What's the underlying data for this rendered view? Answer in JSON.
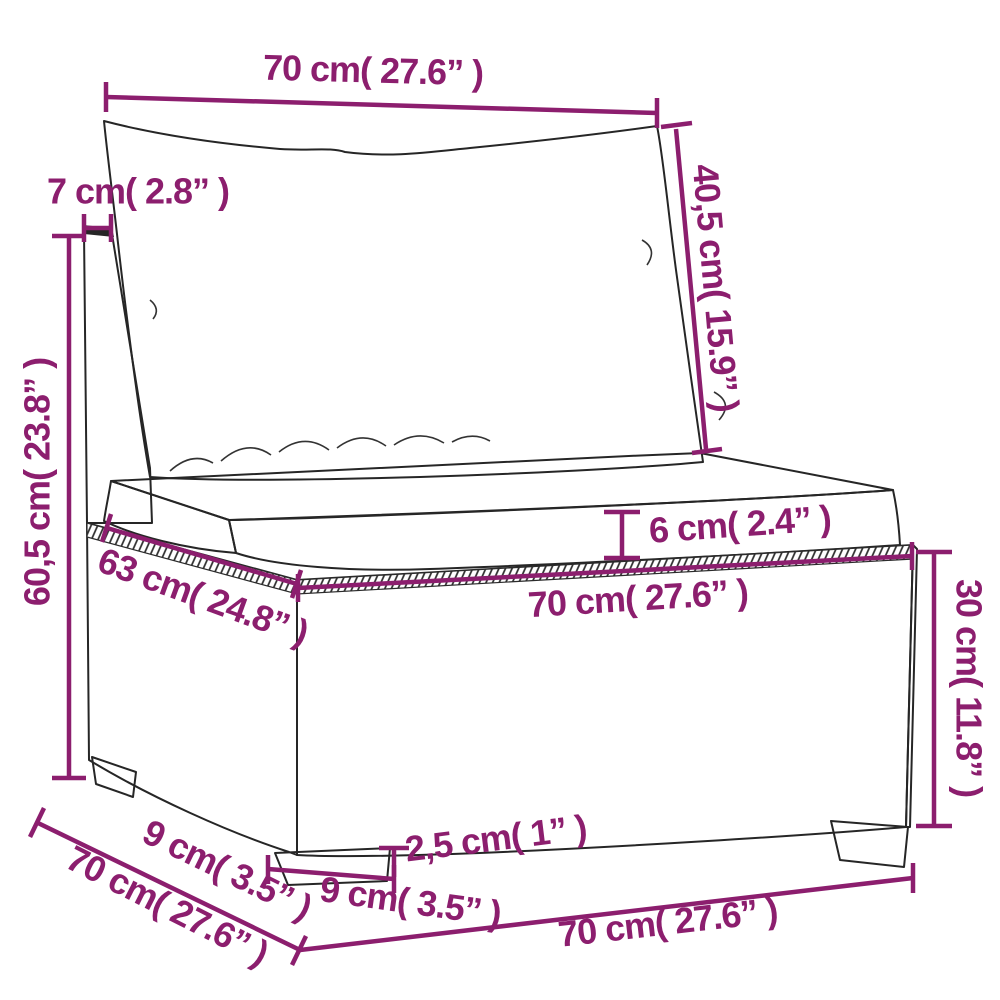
{
  "diagram": {
    "subject": "rattan-sofa-middle-section-with-cushions",
    "accent_color": "#8c1e6e",
    "outline_color": "#262626",
    "background_color": "#ffffff"
  },
  "dims": {
    "top_width": "70 cm( 27.6” )",
    "frame_thickness": "7 cm( 2.8” )",
    "back_cushion_height": "40,5 cm( 15.9” )",
    "total_height": "60,5 cm( 23.8” )",
    "cushion_thickness": "6 cm( 2.4” )",
    "seat_width": "70 cm( 27.6” )",
    "seat_depth": "63 cm( 24.8” )",
    "base_height": "30 cm( 11.8” )",
    "depth_segment": "9 cm( 3.5” )",
    "overall_depth": "70 cm( 27.6” )",
    "leg_width": "9 cm( 3.5” )",
    "leg_height": "2,5 cm( 1” )",
    "overall_width": "70 cm( 27.6” )"
  }
}
